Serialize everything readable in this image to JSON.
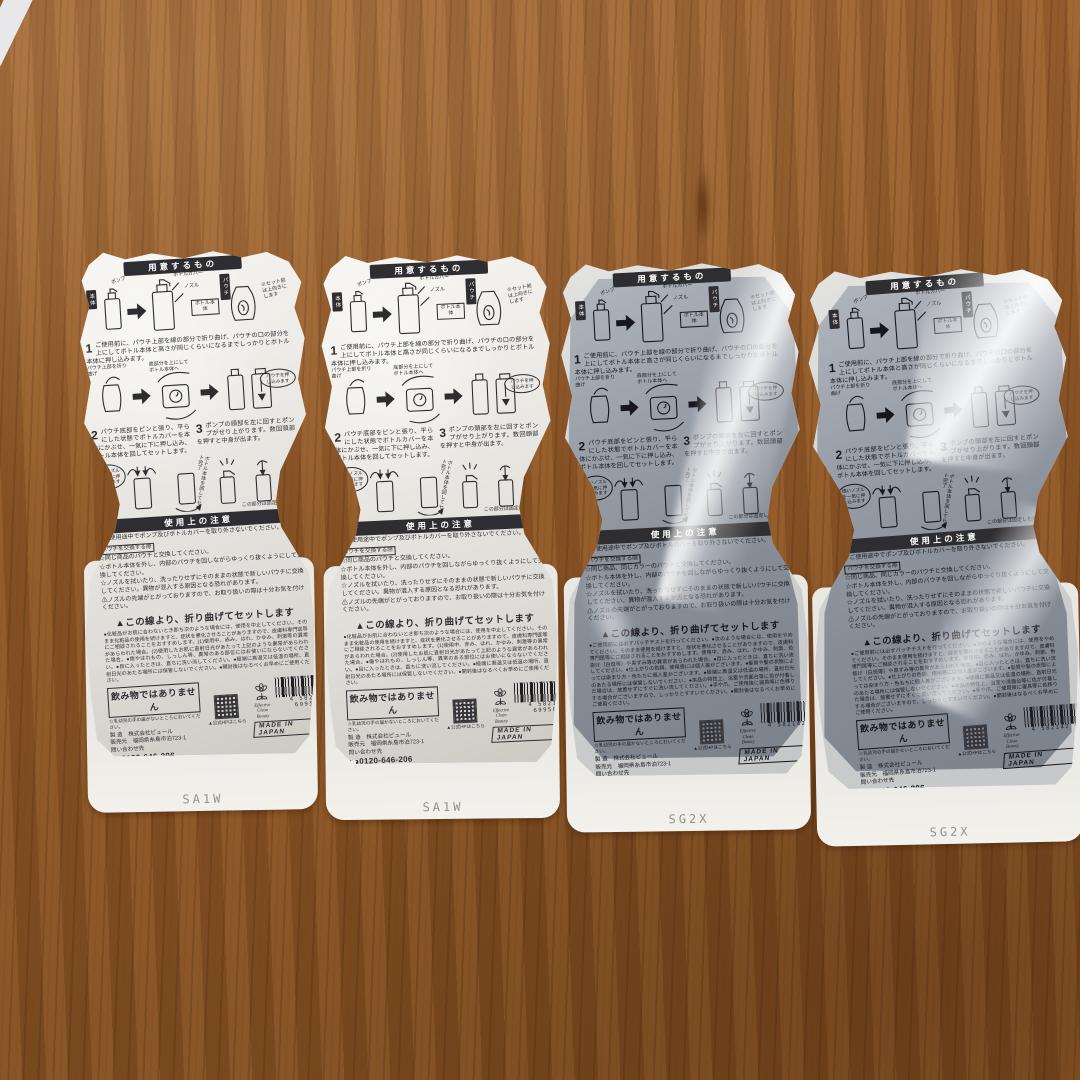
{
  "colors": {
    "wood_brown": "#8d5626",
    "pouch_white": "#ece9e4",
    "pouch_gray": "#8a919b",
    "ink_black": "#2e2e32"
  },
  "shared": {
    "header_prepare": "用意するもの",
    "header_caution": "使用上の注意",
    "diagram_labels": {
      "body_tag": "本体",
      "pump": "ポンプ",
      "bottle_cover": "ボトルカバー",
      "nozzle": "ノズル",
      "bottle_body": "ボトル本体",
      "pouch_tag": "パウチ",
      "preset_note": "※セット前は上向きにします",
      "fold_note": "パウチ上部を折り曲げ",
      "bottom_up": "底部分を上にしてボトル本体へ",
      "push_bubble": "パウチを押し込みます",
      "nozzle_bubble": "細いノズルを一気に押し込みます",
      "rotate_set": "ボトル本体を回してセット完了",
      "hold_note": "この部分は固定したまま"
    },
    "steps": {
      "step1_num": "1",
      "step1": "ご使用前に、パウチ上部を線の部分で折り曲げ、パウチの口の部分を上にしてボトル本体と高さが同じくらいになるまでしっかりとボトル本体に押し込みます。",
      "step2_num": "2",
      "step2": "パウチ底部をピンと張り、平らにした状態でボトルカバーを本体にかぶせ、一気に下に押し込み、ボトル本体を回してセットします。",
      "step3_num": "3",
      "step3": "ポンプの頭部を左に回すとポンプがせり上がります。数回頭部を押すと中身が出ます。"
    },
    "cautions": {
      "no_remove": "☆ご使用途中でポンプ及びボトルカバーを取り外さないでください。",
      "swap_box": "パウチを交換する際",
      "swap_pull": "☆ボトル本体を外し、内部のパウチを回しながらゆっくり抜くようにして交換してください。",
      "swap_clean": "☆ノズルを拭いたり、洗ったりせずにそのままの状態で新しいパウチに交換してください。異物が混入する原因となる恐れがあります。",
      "tip_warning": "⚠ノズルの先端がとがっておりますので、お取り扱いの際は十分お気を付けください。"
    },
    "fold_line": "▲この線より、折り曲げてセットします",
    "not_drink": "飲み物ではありません",
    "keep_away": "☆乳幼児の手の届かないところにおいてください。",
    "company": {
      "maker_row": "製 造　株式会社ピュール",
      "seller_row": "販売元　福岡県糸島市泊723-1",
      "contact_label": "問い合わせ先",
      "phone": "0120-646-206",
      "hp_note": "▲公式HPはこちら"
    },
    "brand_name": "Effective Clean Beauty",
    "made_in": "MADE IN JAPAN",
    "pla_mark": "プラ"
  },
  "pouches": [
    {
      "variant": "white",
      "swap_same": "☆同じ商品のパウチと交換してください。",
      "fineprint": "●化粧品がお肌に合わないとき即ち次のような場合には、使用を中止してください。そのまま化粧品の使用を続けますと、症状を悪化させることがありますので、皮膚科専門医等にご相談されることをおすすめします。(1)使用中、赤み、はれ、かゆみ、刺激等の異常があらわれた場合。(2)使用したお肌に直射日光があたって上記のような異常があらわれた場合。●傷やはれもの、しっしん等、異常のある部位にはお使いにならないでください。●目に入ったときは、直ちに洗い流してください。●極端に高温又は低温の場所、直射日光のあたる場所には保管しないでください。●開封後はなるべくお早めにご使用ください。",
      "barcode_digits": "4 582142 699503",
      "bottom_code": "SA1W"
    },
    {
      "variant": "white",
      "swap_same": "☆同じ商品のパウチと交換してください。",
      "fineprint": "●化粧品がお肌に合わないとき即ち次のような場合には、使用を中止してください。そのまま化粧品の使用を続けますと、症状を悪化させることがありますので、皮膚科専門医等にご相談されることをおすすめします。(1)使用中、赤み、はれ、かゆみ、刺激等の異常があらわれた場合。(2)使用したお肌に直射日光があたって上記のような異常があらわれた場合。●傷やはれもの、しっしん等、異常のある部位にはお使いにならないでください。●目に入ったときは、直ちに洗い流してください。●極端に高温又は低温の場所、直射日光のあたる場所には保管しないでください。●開封後はなるべくお早めにご使用ください。",
      "barcode_digits": "4 582142 699503",
      "bottom_code": "SA1W"
    },
    {
      "variant": "gray",
      "swap_same": "☆同じ商品、同じカラーのパウチと交換してください。",
      "fineprint": "●ご使用前には必ずパッチテストを行ってください。●次のような場合には、使用をやめてください。そのまま使用を続けますと、症状を悪化させることがありますので、皮膚科専門医等にご相談されることをおすすめします。使用中、赤み、はれ、かゆみ、刺激、色抜け（白斑等）や黒ずみ等の異常があらわれた場合。●目に入ったときは、直ちに洗い流してください。●仕上がりの色調、使用感には個人差がございます。●髪質や髪の状態によっては染まり方・色もちに個人差がございます。●極端に高温又は低温の場所、直射日光のあたる場所には保管しないでください。●本品の特性上、浴室や洗面台等に色が付着した場合は、放置せずにすぐに洗い流してください。●手や爪、ご使用後に寝具等に色移りする場合がございますので、しっかりとすすいでください。●開封後はなるべくお早めにご使用ください。",
      "barcode_digits": "4 582142 69",
      "bottom_code": "SG2X"
    },
    {
      "variant": "gray",
      "swap_same": "☆同じ商品、同じカラーのパウチと交換してください。",
      "fineprint": "●ご使用前には必ずパッチテストを行ってください。●次のような場合には、使用をやめてください。そのまま使用を続けますと、症状を悪化させることがありますので、皮膚科専門医等にご相談されることをおすすめします。使用中、赤み、はれ、かゆみ、刺激、色抜け（白斑等）や黒ずみ等の異常があらわれた場合。●目に入ったときは、直ちに洗い流してください。●仕上がりの色調、使用感には個人差がございます。●髪質や髪の状態によっては染まり方・色もちに個人差がございます。●極端に高温又は低温の場所、直射日光のあたる場所には保管しないでください。●本品の特性上、浴室や洗面台等に色が付着した場合は、放置せずにすぐに洗い流してください。●手や爪、ご使用後に寝具等に色移りする場合がございますので、しっかりとすすいでください。●開封後はなるべくお早めにご使用ください。",
      "barcode_digits": "4 582142 69",
      "bottom_code": "SG2X"
    }
  ]
}
